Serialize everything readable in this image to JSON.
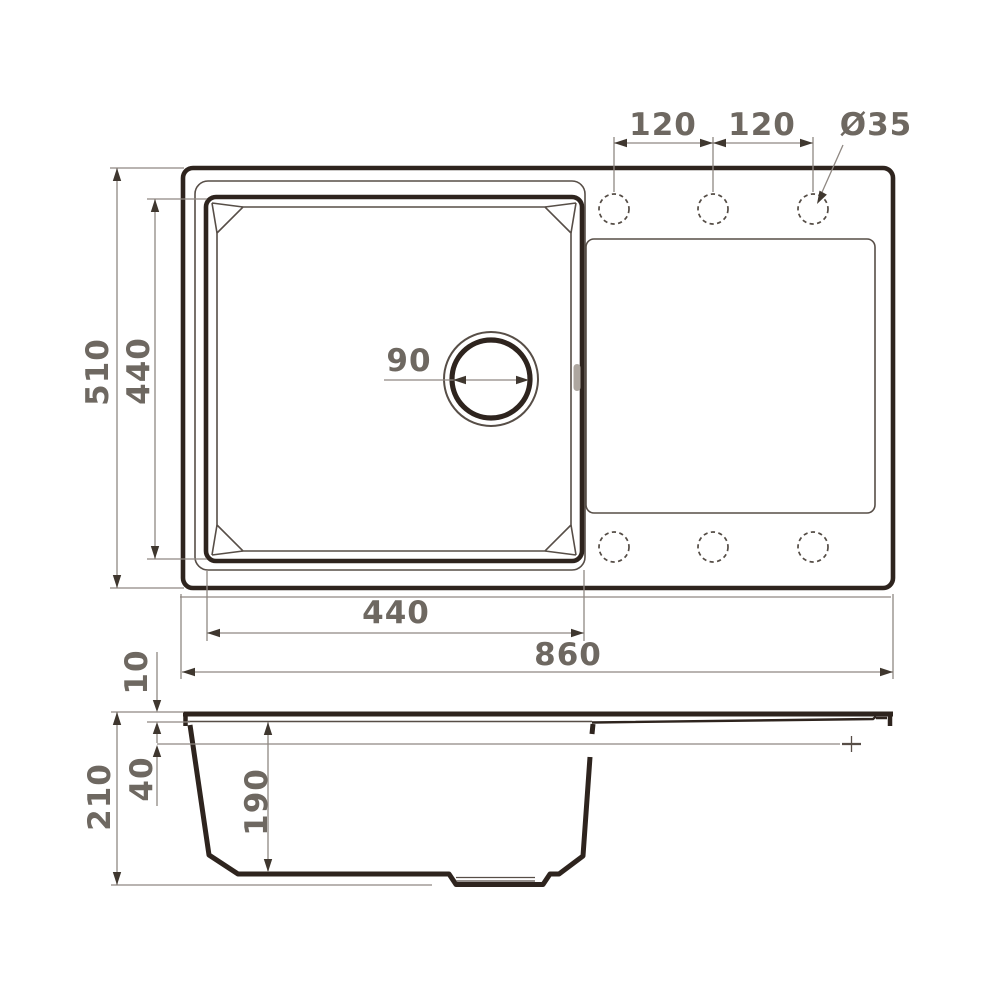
{
  "drawing": {
    "type": "sink-technical-drawing",
    "views": {
      "top_view": {
        "dimensions": {
          "hole_pitch_left": "120",
          "hole_pitch_right": "120",
          "hole_diameter": "Ø35",
          "outer_width": "510",
          "bowl_width": "440",
          "drain_diameter": "90",
          "bowl_length": "440",
          "outer_length": "860"
        }
      },
      "section_view": {
        "dimensions": {
          "rim_height": "10",
          "overflow_depth": "40",
          "bowl_depth": "190",
          "overall_depth": "210"
        }
      }
    },
    "colors": {
      "outline_ink": "#2e241e",
      "thin_ink": "#574e47",
      "dimension_lines": "#8f8882",
      "dimension_text": "#6e6861",
      "background": "#ffffff"
    }
  }
}
